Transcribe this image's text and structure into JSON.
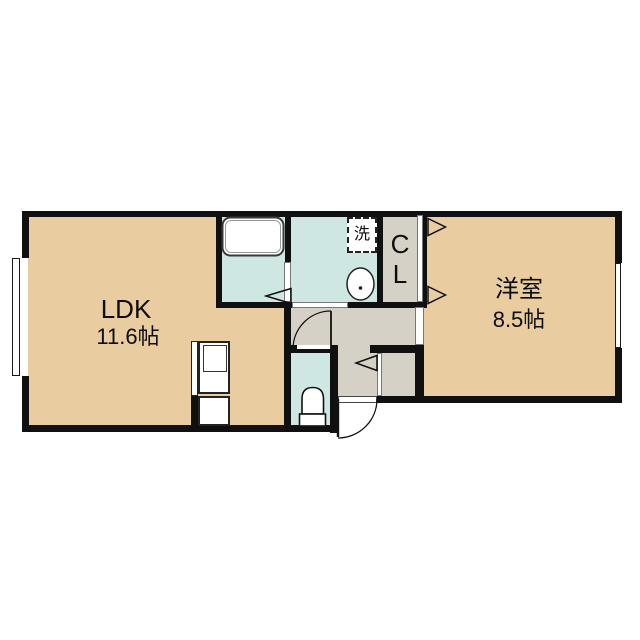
{
  "plan_title": "1LDK apartment floor plan",
  "colors": {
    "floor_tan": "#e9cda0",
    "floor_cyan": "#cfe7e3",
    "floor_gray": "#d5d1c6",
    "wall": "#101010"
  },
  "rooms": {
    "ldk": {
      "label": "LDK",
      "size": "11.6帖"
    },
    "western": {
      "label": "洋室",
      "size": "8.5帖"
    },
    "closet": {
      "letter_top": "C",
      "letter_bottom": "L"
    },
    "laundry": {
      "label": "洗"
    }
  }
}
